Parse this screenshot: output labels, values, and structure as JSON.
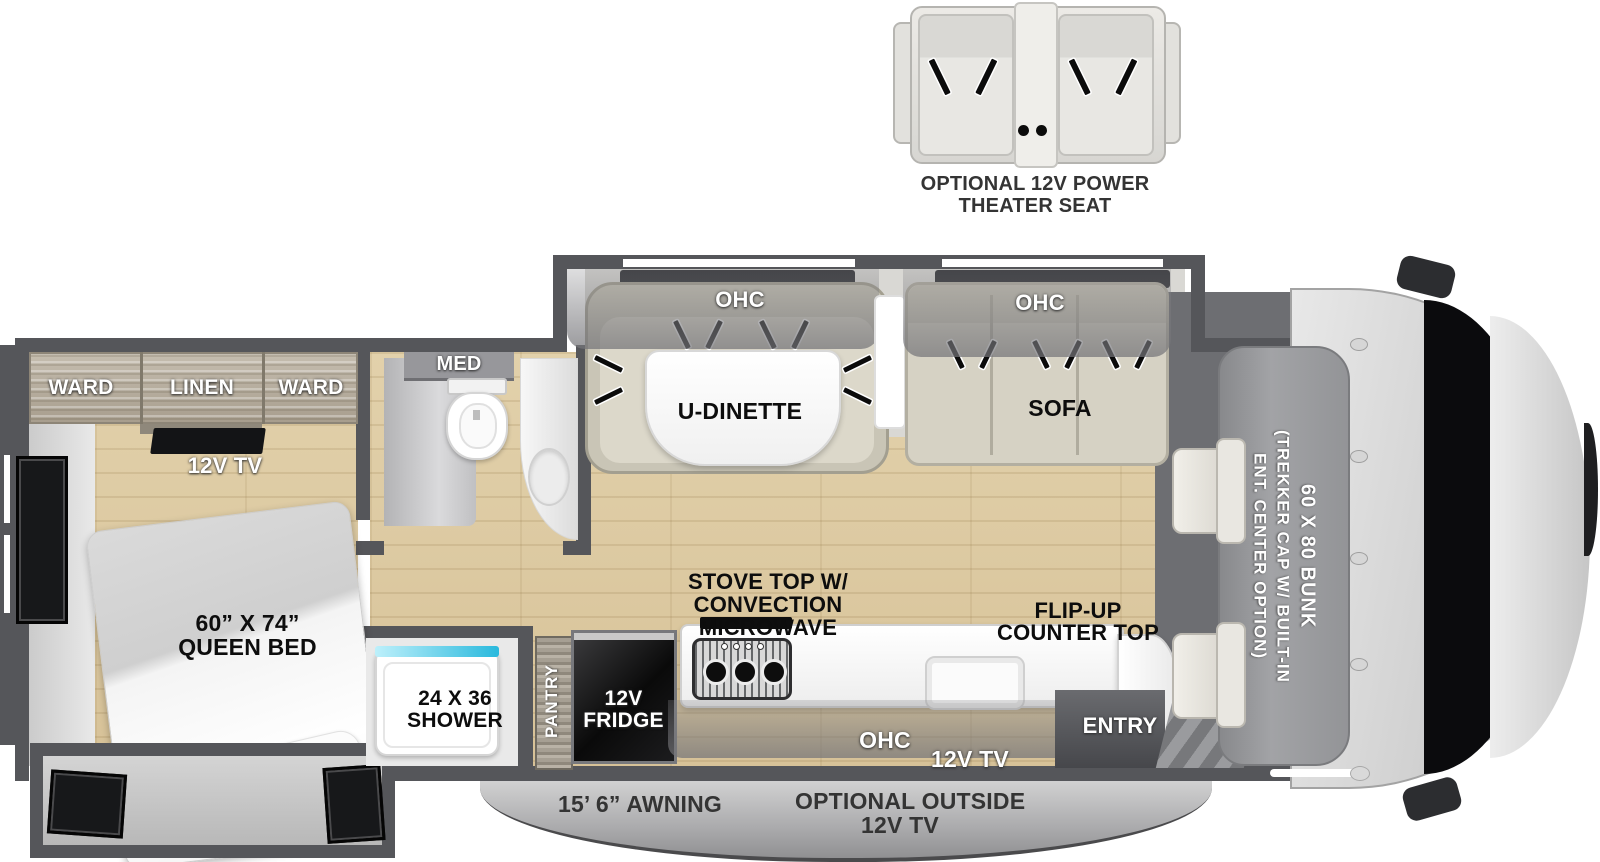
{
  "diagram_type": "rv-floorplan-top-view",
  "exterior": {
    "theater_seat": {
      "line1": "OPTIONAL 12V POWER",
      "line2": "THEATER SEAT"
    },
    "awning": "15’ 6” AWNING",
    "outside_tv": {
      "line1": "OPTIONAL OUTSIDE",
      "line2": "12V TV"
    }
  },
  "living": {
    "dinette_ohc": "OHC",
    "dinette": "U-DINETTE",
    "sofa_ohc": "OHC",
    "sofa": "SOFA"
  },
  "cab": {
    "bunk_size": "60 X 80 BUNK",
    "bunk_option1": "(TREKKER CAP W/ BUILT-IN",
    "bunk_option2": "ENT. CENTER OPTION)"
  },
  "bedroom": {
    "ward_left": "WARD",
    "linen": "LINEN",
    "ward_right": "WARD",
    "tv": "12V TV",
    "bed_size": "60” X 74”",
    "bed_type": "QUEEN BED"
  },
  "bathroom": {
    "med": "MED",
    "shower_size": "24 X 36",
    "shower": "SHOWER"
  },
  "kitchen": {
    "pantry": "PANTRY",
    "fridge1": "12V",
    "fridge2": "FRIDGE",
    "stove1": "STOVE TOP W/",
    "stove2": "CONVECTION",
    "stove3": "MICROWAVE",
    "flip1": "FLIP-UP",
    "flip2": "COUNTER TOP",
    "ohc": "OHC",
    "tv": "12V TV"
  },
  "entry": {
    "label": "ENTRY"
  },
  "colors": {
    "wall": "#55565a",
    "wood_floor": "#ddc9a1",
    "bench": "#d4d0c2",
    "shower_accent": "#29b9dd",
    "fridge": "#0d0d0d",
    "label_dark": "#0d0d0d",
    "label_outside": "#343434",
    "bunk": "#98999c"
  }
}
